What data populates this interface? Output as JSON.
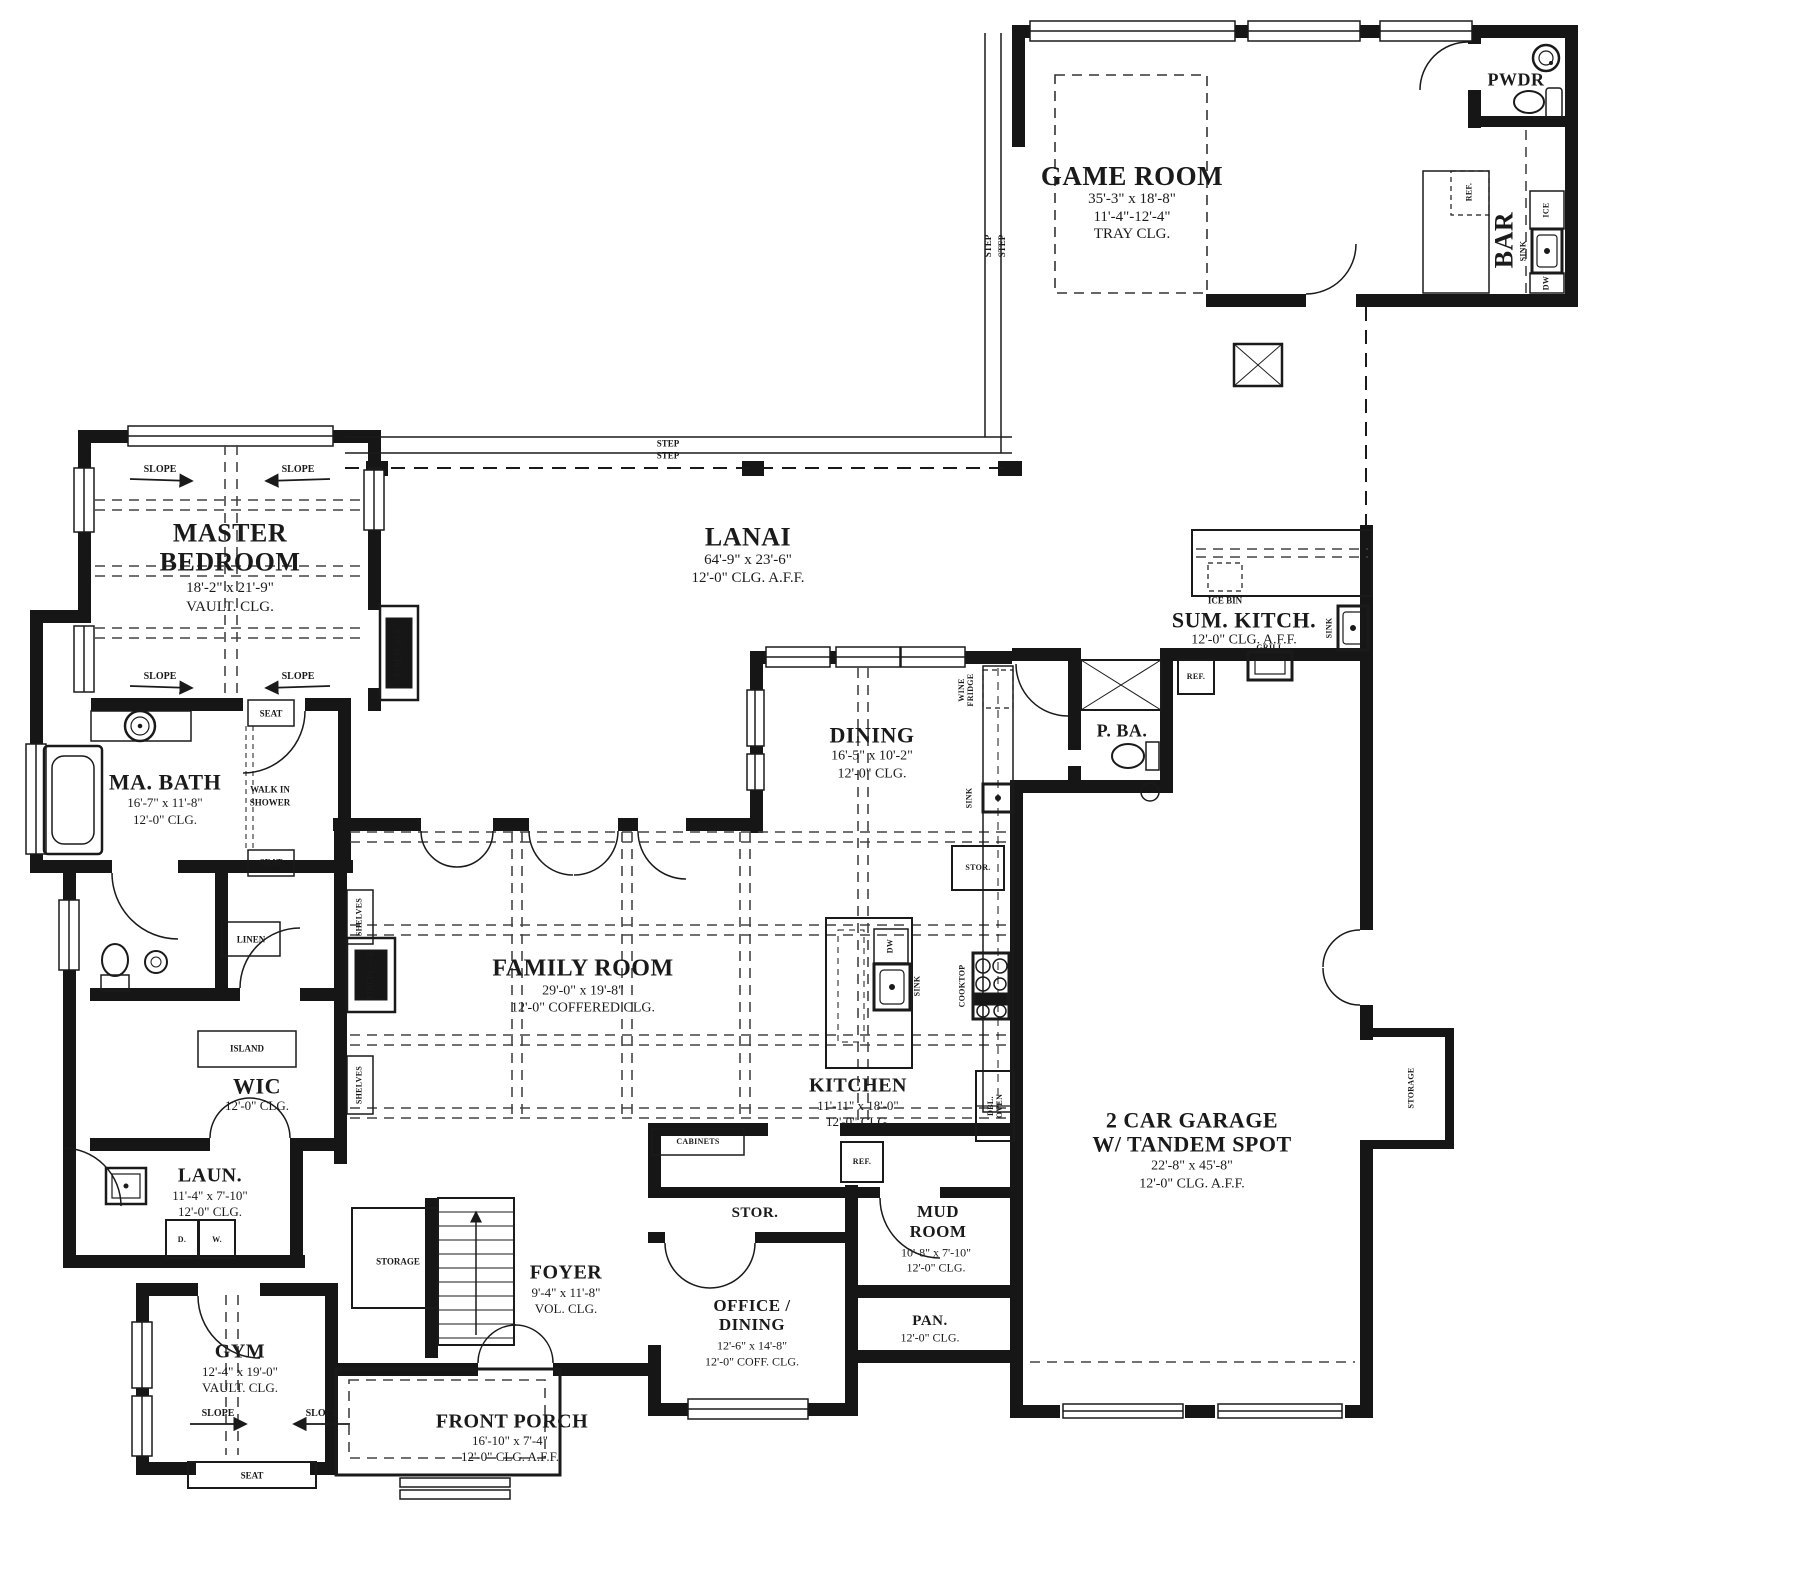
{
  "rooms": {
    "game_room": {
      "name": "GAME ROOM",
      "dim": "35'-3\" x 18'-8\"",
      "ceiling1": "11'-4\"-12'-4\"",
      "ceiling2": "TRAY CLG."
    },
    "pwdr": {
      "name": "PWDR"
    },
    "bar": {
      "name": "BAR"
    },
    "lanai": {
      "name": "LANAI",
      "dim": "64'-9\" x 23'-6\"",
      "ceiling": "12'-0\" CLG. A.F.F."
    },
    "sum_kitch": {
      "name": "SUM. KITCH.",
      "ceiling": "12'-0\" CLG. A.F.F."
    },
    "master_bedroom": {
      "name1": "MASTER",
      "name2": "BEDROOM",
      "dim": "18'-2\" x 21'-9\"",
      "ceiling": "VAULT. CLG."
    },
    "ma_bath": {
      "name": "MA. BATH",
      "dim": "16'-7\" x 11'-8\"",
      "ceiling": "12'-0\" CLG."
    },
    "dining": {
      "name": "DINING",
      "dim": "16'-5\" x 10'-2\"",
      "ceiling": "12'-0\" CLG."
    },
    "p_ba": {
      "name": "P. BA."
    },
    "family_room": {
      "name": "FAMILY ROOM",
      "dim": "29'-0\" x 19'-8\"",
      "ceiling": "12'-0\" COFFERED CLG."
    },
    "kitchen": {
      "name": "KITCHEN",
      "dim": "11'-11\" x 18'-0\"",
      "ceiling": "12'-0\" CLG."
    },
    "wic": {
      "name": "WIC",
      "ceiling": "12'-0\" CLG."
    },
    "laundry": {
      "name": "LAUN.",
      "dim": "11'-4\" x 7'-10\"",
      "ceiling": "12'-0\" CLG."
    },
    "gym": {
      "name": "GYM",
      "dim": "12'-4\" x 19'-0\"",
      "ceiling": "VAULT. CLG."
    },
    "foyer": {
      "name": "FOYER",
      "dim": "9'-4\" x 11'-8\"",
      "ceiling": "VOL. CLG."
    },
    "stor_room": {
      "name": "STOR."
    },
    "office_dining": {
      "name1": "OFFICE /",
      "name2": "DINING",
      "dim": "12'-6\" x 14'-8\"",
      "ceiling": "12'-0\" COFF. CLG."
    },
    "mud_room": {
      "name1": "MUD",
      "name2": "ROOM",
      "dim": "10'-8\" x 7'-10\"",
      "ceiling": "12'-0\" CLG."
    },
    "pantry": {
      "name": "PAN.",
      "ceiling": "12'-0\" CLG."
    },
    "garage": {
      "name1": "2 CAR GARAGE",
      "name2": "W/ TANDEM SPOT",
      "dim": "22'-8\" x 45'-8\"",
      "ceiling": "12'-0\" CLG. A.F.F."
    },
    "front_porch": {
      "name": "FRONT PORCH",
      "dim": "16'-10\" x 7'-4\"",
      "ceiling": "12'-0\" CLG. A.F.F."
    }
  },
  "features": {
    "step": "STEP",
    "slope": "SLOPE",
    "seat": "SEAT",
    "shelves": "SHELVES",
    "fireplace": "FIREPLACE",
    "walk_in1": "WALK IN",
    "walk_in2": "SHOWER",
    "linen": "LINEN",
    "island": "ISLAND",
    "ice_bin": "ICE BIN",
    "grill": "GRILL",
    "sink": "SINK",
    "ref": "REF.",
    "ice": "ICE",
    "dw": "DW",
    "wine1": "WINE",
    "wine2": "FRIDGE",
    "cooktop": "COOKTOP",
    "dbl1": "DBL.",
    "dbl2": "OVEN",
    "cabinets": "CABINETS",
    "dryer": "D.",
    "washer": "W.",
    "storage": "STORAGE",
    "stor_closet": "STOR."
  }
}
